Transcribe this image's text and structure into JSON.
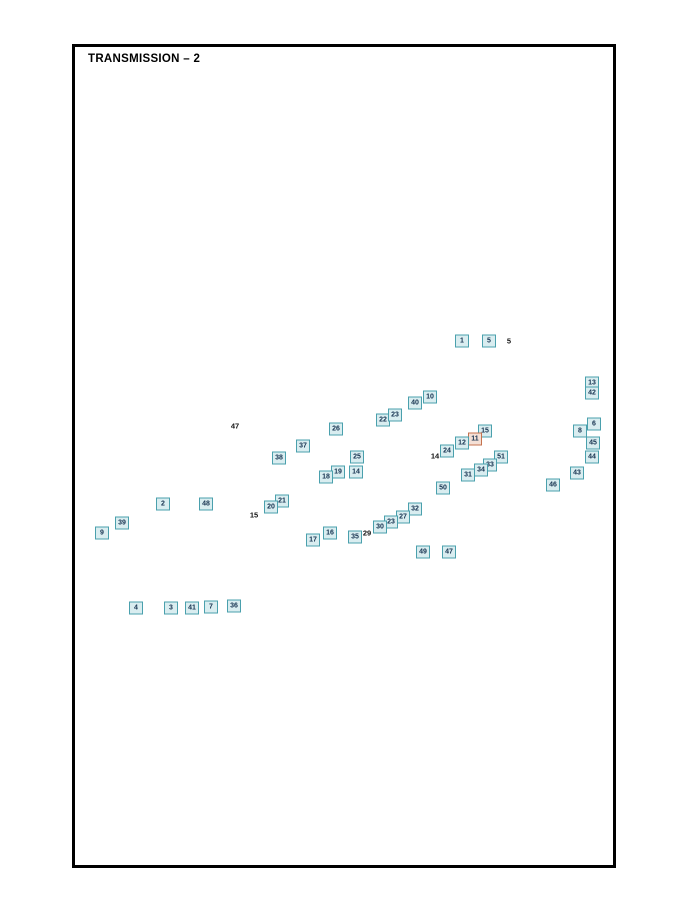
{
  "page": {
    "title": "TRANSMISSION – 2"
  },
  "colors": {
    "callout_border": "#4aa0ad",
    "callout_fill": "#d9edf0",
    "callout_text": "#15314f",
    "highlight_border": "#c4724e",
    "highlight_fill": "#f4e0d6",
    "line_color": "#2a2a2a"
  },
  "diagram": {
    "description": "Exploded view of transmission assembly with numbered part callouts",
    "callouts": [
      {
        "label": "1",
        "style": "box",
        "x": 462,
        "y": 341,
        "tx": 468,
        "ty": 385
      },
      {
        "label": "5",
        "style": "box",
        "x": 489,
        "y": 341,
        "tx": 510,
        "ty": 368
      },
      {
        "label": "5",
        "style": "plain",
        "x": 509,
        "y": 341,
        "tx": 501,
        "ty": 366
      },
      {
        "label": "10",
        "style": "box",
        "x": 430,
        "y": 397,
        "tx": 452,
        "ty": 413
      },
      {
        "label": "40",
        "style": "box",
        "x": 415,
        "y": 403,
        "tx": 420,
        "ty": 424
      },
      {
        "label": "13",
        "style": "box",
        "x": 592,
        "y": 383,
        "tx": 566,
        "ty": 368
      },
      {
        "label": "42",
        "style": "box",
        "x": 592,
        "y": 393,
        "tx": 572,
        "ty": 398
      },
      {
        "label": "6",
        "style": "box",
        "x": 594,
        "y": 424,
        "tx": 589,
        "ty": 409
      },
      {
        "label": "8",
        "style": "box",
        "x": 580,
        "y": 431,
        "tx": 582,
        "ty": 414
      },
      {
        "label": "45",
        "style": "box",
        "x": 593,
        "y": 443,
        "tx": 564,
        "ty": 445
      },
      {
        "label": "44",
        "style": "box",
        "x": 592,
        "y": 457,
        "tx": 573,
        "ty": 453
      },
      {
        "label": "43",
        "style": "box",
        "x": 577,
        "y": 473,
        "tx": 559,
        "ty": 461
      },
      {
        "label": "46",
        "style": "box",
        "x": 553,
        "y": 485,
        "tx": 548,
        "ty": 471
      },
      {
        "label": "22",
        "style": "box",
        "x": 383,
        "y": 420,
        "tx": 390,
        "ty": 443
      },
      {
        "label": "23",
        "style": "box",
        "x": 395,
        "y": 415,
        "tx": 404,
        "ty": 438
      },
      {
        "label": "26",
        "style": "box",
        "x": 336,
        "y": 429,
        "tx": 344,
        "ty": 449
      },
      {
        "label": "47",
        "style": "plain",
        "x": 235,
        "y": 426,
        "tx": 172,
        "ty": 497
      },
      {
        "label": "37",
        "style": "box",
        "x": 303,
        "y": 446,
        "tx": 310,
        "ty": 458
      },
      {
        "label": "38",
        "style": "box",
        "x": 279,
        "y": 458,
        "tx": 288,
        "ty": 466
      },
      {
        "label": "25",
        "style": "box",
        "x": 357,
        "y": 457,
        "tx": 360,
        "ty": 470
      },
      {
        "label": "19",
        "style": "box",
        "x": 338,
        "y": 472,
        "tx": 344,
        "ty": 487
      },
      {
        "label": "14",
        "style": "box",
        "x": 356,
        "y": 472,
        "tx": 359,
        "ty": 486
      },
      {
        "label": "18",
        "style": "box",
        "x": 326,
        "y": 477,
        "tx": 333,
        "ty": 494
      },
      {
        "label": "24",
        "style": "box",
        "x": 447,
        "y": 451,
        "tx": 452,
        "ty": 441
      },
      {
        "label": "14",
        "style": "plain",
        "x": 435,
        "y": 456,
        "tx": 441,
        "ty": 449
      },
      {
        "label": "15",
        "style": "box",
        "x": 485,
        "y": 431,
        "tx": 479,
        "ty": 443
      },
      {
        "label": "11",
        "style": "highlight",
        "x": 475,
        "y": 439,
        "tx": 470,
        "ty": 450
      },
      {
        "label": "12",
        "style": "box",
        "x": 462,
        "y": 443,
        "tx": 459,
        "ty": 454
      },
      {
        "label": "51",
        "style": "box",
        "x": 501,
        "y": 457,
        "tx": 492,
        "ty": 464
      },
      {
        "label": "33",
        "style": "box",
        "x": 490,
        "y": 465,
        "tx": 482,
        "ty": 473
      },
      {
        "label": "34",
        "style": "box",
        "x": 481,
        "y": 470,
        "tx": 473,
        "ty": 480
      },
      {
        "label": "31",
        "style": "box",
        "x": 468,
        "y": 475,
        "tx": 463,
        "ty": 487
      },
      {
        "label": "50",
        "style": "box",
        "x": 443,
        "y": 488,
        "tx": 452,
        "ty": 501
      },
      {
        "label": "32",
        "style": "box",
        "x": 415,
        "y": 509,
        "tx": 420,
        "ty": 496
      },
      {
        "label": "27",
        "style": "box",
        "x": 403,
        "y": 517,
        "tx": 408,
        "ty": 501
      },
      {
        "label": "23",
        "style": "box",
        "x": 391,
        "y": 522,
        "tx": 396,
        "ty": 506
      },
      {
        "label": "30",
        "style": "box",
        "x": 380,
        "y": 527,
        "tx": 384,
        "ty": 510
      },
      {
        "label": "35",
        "style": "box",
        "x": 355,
        "y": 537,
        "tx": 359,
        "ty": 522
      },
      {
        "label": "29",
        "style": "plain",
        "x": 367,
        "y": 533,
        "tx": 371,
        "ty": 521
      },
      {
        "label": "49",
        "style": "box",
        "x": 423,
        "y": 552,
        "tx": 428,
        "ty": 527
      },
      {
        "label": "47",
        "style": "box",
        "x": 449,
        "y": 552,
        "tx": 441,
        "ty": 530
      },
      {
        "label": "16",
        "style": "box",
        "x": 330,
        "y": 533,
        "tx": 334,
        "ty": 517
      },
      {
        "label": "17",
        "style": "box",
        "x": 313,
        "y": 540,
        "tx": 316,
        "ty": 524
      },
      {
        "label": "21",
        "style": "box",
        "x": 282,
        "y": 501,
        "tx": 277,
        "ty": 516
      },
      {
        "label": "20",
        "style": "box",
        "x": 271,
        "y": 507,
        "tx": 269,
        "ty": 521
      },
      {
        "label": "15",
        "style": "plain",
        "x": 254,
        "y": 515,
        "tx": 264,
        "ty": 525
      },
      {
        "label": "2",
        "style": "box",
        "x": 163,
        "y": 504,
        "tx": 173,
        "ty": 517
      },
      {
        "label": "48",
        "style": "box",
        "x": 206,
        "y": 504,
        "tx": 207,
        "ty": 529
      },
      {
        "label": "39",
        "style": "box",
        "x": 122,
        "y": 523,
        "tx": 144,
        "ty": 547
      },
      {
        "label": "9",
        "style": "box",
        "x": 102,
        "y": 533,
        "tx": 110,
        "ty": 555
      },
      {
        "label": "4",
        "style": "box",
        "x": 136,
        "y": 608,
        "tx": 144,
        "ty": 595
      },
      {
        "label": "3",
        "style": "box",
        "x": 171,
        "y": 608,
        "tx": 173,
        "ty": 591
      },
      {
        "label": "41",
        "style": "box",
        "x": 192,
        "y": 608,
        "tx": 194,
        "ty": 586
      },
      {
        "label": "7",
        "style": "box",
        "x": 211,
        "y": 607,
        "tx": 213,
        "ty": 586
      },
      {
        "label": "36",
        "style": "box",
        "x": 234,
        "y": 606,
        "tx": 235,
        "ty": 587
      }
    ]
  }
}
